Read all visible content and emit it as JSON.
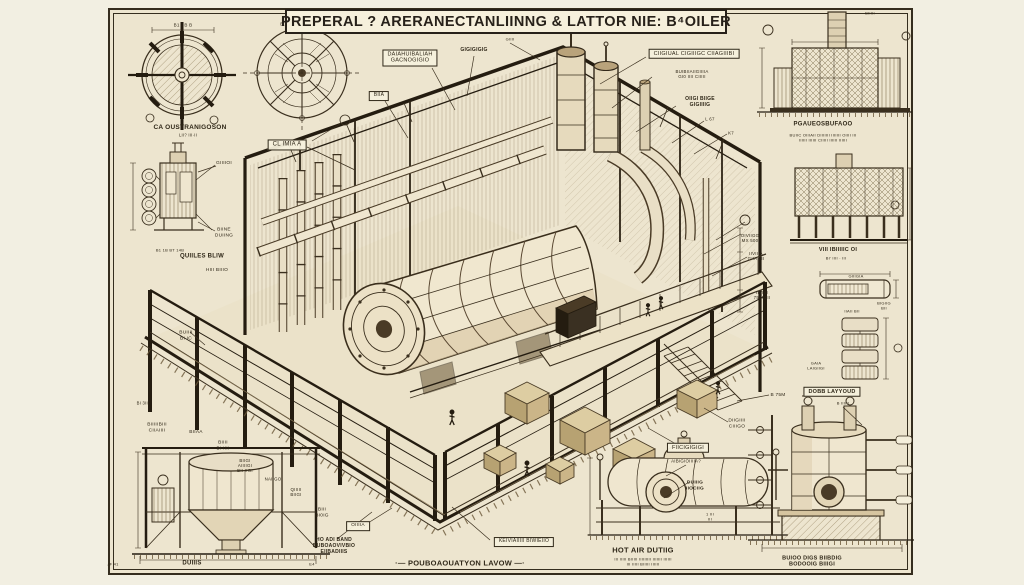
{
  "title": {
    "text": "PREPERAL ? ARERANECTANLIINNG & LATTOR NIE: B⁴OILER"
  },
  "colors": {
    "paper_margin": "#f2efe2",
    "paper_sheet": "#ede5cf",
    "ink_dark": "#241c10",
    "ink": "#3a2f1e",
    "ink_mid": "#6b5939",
    "fill_light": "#efe6cf",
    "fill_tan": "#ddd0b2",
    "fill_shade": "#d9c7a2",
    "crate_top": "#ddcda2",
    "crate_left": "#b7a272",
    "crate_right": "#cbb588"
  },
  "drawing_names": [
    "fan-section-circle-a",
    "impeller-section-circle-b",
    "left-tank-detail",
    "main-isometric-plant",
    "right-top-furnace-elevation",
    "right-mid-furnace-elevation",
    "duct-detail",
    "stacked-module-detail",
    "bottom-left-hopper",
    "hot-air-horizontal-boiler",
    "bottom-right-vertical-boiler",
    "foundation-layout"
  ],
  "labels": [
    {
      "t": "B1 · B  B",
      "x": 183,
      "y": 25,
      "s": 4.5
    },
    {
      "t": "B.BI",
      "x": 285,
      "y": 24,
      "s": 4.5
    },
    {
      "t": "CA OUSTRANIGOSON",
      "x": 190,
      "y": 128,
      "s": 6.5,
      "b": 1,
      "name": "caption-fan-section"
    },
    {
      "t": "LII? III·II",
      "x": 188,
      "y": 136,
      "s": 4.2
    },
    {
      "t": "CL IMIA  A",
      "x": 287,
      "y": 145,
      "s": 6,
      "box": 1,
      "name": "callout-cl-imia"
    },
    {
      "t": "GIIIIOI",
      "x": 224,
      "y": 164,
      "s": 4.8
    },
    {
      "t": "BIINE\nDUIING",
      "x": 224,
      "y": 233,
      "s": 4.8
    },
    {
      "t": "B1 1B      BT 14B",
      "x": 170,
      "y": 251,
      "s": 4
    },
    {
      "t": "QUIILES BLIW",
      "x": 202,
      "y": 257,
      "s": 6,
      "b": 1,
      "name": "caption-left-tank"
    },
    {
      "t": "HIII BIIIO",
      "x": 217,
      "y": 271,
      "s": 4.8
    },
    {
      "t": "BUIIII\nBI IC",
      "x": 186,
      "y": 336,
      "s": 4.8
    },
    {
      "t": "BI 3III",
      "x": 143,
      "y": 404,
      "s": 4.2
    },
    {
      "t": "BIIIIIBIII\nCIIAIIII",
      "x": 157,
      "y": 428,
      "s": 4.8
    },
    {
      "t": "BIIAA",
      "x": 196,
      "y": 433,
      "s": 4.8
    },
    {
      "t": "BIIII\nBI IIII",
      "x": 223,
      "y": 446,
      "s": 4.8
    },
    {
      "t": "BIIGI\nAIIIIGI\nBII IIGI",
      "x": 245,
      "y": 466,
      "s": 4.4
    },
    {
      "t": "NAIIGO",
      "x": 273,
      "y": 479,
      "s": 4.4
    },
    {
      "t": "QIIIII\nBIIGI",
      "x": 296,
      "y": 492,
      "s": 4.4
    },
    {
      "t": "BIII\nBI0IG",
      "x": 322,
      "y": 513,
      "s": 4.8
    },
    {
      "t": "OIIIIA",
      "x": 358,
      "y": 526,
      "s": 4.8,
      "box": 1
    },
    {
      "t": "HO ADI BAND\nBUBOAOVIVBIO\nEIIBADIIIS",
      "x": 334,
      "y": 547,
      "s": 5,
      "b": 1
    },
    {
      "t": "KEIVIAIIIII  BIWIEIIO",
      "x": 524,
      "y": 542,
      "s": 5,
      "box": 1
    },
    {
      "t": "·—   POUBOAOUATYON  LAVOW   —·",
      "x": 460,
      "y": 564,
      "s": 7.5,
      "b": 1,
      "name": "caption-foundation-layout"
    },
    {
      "t": "DUIIIS",
      "x": 192,
      "y": 564,
      "s": 6,
      "b": 1,
      "name": "caption-hopper"
    },
    {
      "t": "JF 41",
      "x": 113,
      "y": 565,
      "s": 4
    },
    {
      "t": "E4",
      "x": 312,
      "y": 565,
      "s": 4
    },
    {
      "t": "BIIA",
      "x": 379,
      "y": 96,
      "s": 5,
      "box": 1
    },
    {
      "t": "DAIAHUIBALIAH\nGACNOGIGIO",
      "x": 410,
      "y": 58,
      "s": 5.5,
      "box": 1,
      "name": "callout-top-left"
    },
    {
      "t": "GIGIGIGIG",
      "x": 474,
      "y": 51,
      "s": 5,
      "b": 1
    },
    {
      "t": "GIIII",
      "x": 510,
      "y": 40,
      "s": 4
    },
    {
      "t": "CIIGIUAL CIGIIIGC CIIAGIIIBI",
      "x": 694,
      "y": 54,
      "s": 5.5,
      "box": 1,
      "name": "callout-top-right"
    },
    {
      "t": "BUIBIIAIIGIIIIA\nGI0 IIII CIIIII",
      "x": 692,
      "y": 74,
      "s": 4.4
    },
    {
      "t": "OIIGI BIIGE\nGIGIIIIG",
      "x": 700,
      "y": 103,
      "s": 5,
      "b": 1
    },
    {
      "t": "L 67",
      "x": 710,
      "y": 119,
      "s": 4.4
    },
    {
      "t": "K7",
      "x": 731,
      "y": 133,
      "s": 4.4
    },
    {
      "t": "BIIIII",
      "x": 870,
      "y": 14,
      "s": 4
    },
    {
      "t": "PGAUEOSBUFAOO",
      "x": 823,
      "y": 125,
      "s": 6,
      "b": 1,
      "name": "caption-right-top"
    },
    {
      "t": "BUIIC OIIIAII DIIIIIII IIIIIII OIIII III\nIIIIII IIIIII CIIIII IIIIII IIIIII",
      "x": 823,
      "y": 138,
      "s": 4
    },
    {
      "t": "VIII IBIIIIIC OI",
      "x": 838,
      "y": 250,
      "s": 5.5,
      "b": 1,
      "name": "caption-right-mid"
    },
    {
      "t": "BI' IIII · III",
      "x": 836,
      "y": 259,
      "s": 4
    },
    {
      "t": "GIIIGIA",
      "x": 856,
      "y": 277,
      "s": 4
    },
    {
      "t": "BIGIIG\nBII",
      "x": 884,
      "y": 306,
      "s": 4
    },
    {
      "t": "IIAII BII",
      "x": 852,
      "y": 312,
      "s": 4
    },
    {
      "t": "GAIA\nLAIGIIGI",
      "x": 816,
      "y": 366,
      "s": 4
    },
    {
      "t": "DOBB LAYYOUD",
      "x": 832,
      "y": 392,
      "s": 5.5,
      "b": 1,
      "box": 1,
      "name": "callout-dobb-layout"
    },
    {
      "t": "OIVIIGG\nMX 500",
      "x": 750,
      "y": 238,
      "s": 4.4
    },
    {
      "t": "IIVIIIA\nGIIA 3II",
      "x": 756,
      "y": 256,
      "s": 4.4
    },
    {
      "t": "IIVIIII\n75I 50II",
      "x": 762,
      "y": 295,
      "s": 4.4
    },
    {
      "t": "B 75M",
      "x": 778,
      "y": 396,
      "s": 4.8
    },
    {
      "t": "DIIGIIII\nCIIIGO",
      "x": 737,
      "y": 424,
      "s": 4.8
    },
    {
      "t": "B IIIIII",
      "x": 843,
      "y": 404,
      "s": 4
    },
    {
      "t": "FIICIGIGIGI",
      "x": 688,
      "y": 448,
      "s": 5.5,
      "box": 1,
      "name": "callout-fiicig"
    },
    {
      "t": "AIBIGIOIIIIA?",
      "x": 686,
      "y": 461,
      "s": 4.4
    },
    {
      "t": "DUIIIG\nIIOCIIG",
      "x": 695,
      "y": 486,
      "s": 4.8,
      "b": 1
    },
    {
      "t": "1 III\nIII",
      "x": 710,
      "y": 517,
      "s": 4
    },
    {
      "t": "HOT AIR DUTIIG",
      "x": 643,
      "y": 551,
      "s": 7.5,
      "b": 1,
      "name": "caption-hot-air"
    },
    {
      "t": "III IIIII BIIIII IIIIIIIII IIIIIII IIIIII\nIII IIIII BIIIII IIIIII",
      "x": 643,
      "y": 562,
      "s": 4
    },
    {
      "t": "BUIOO DIGS BIIBDIG\nBODOOIG BIIIGI",
      "x": 812,
      "y": 562,
      "s": 5.5,
      "b": 1,
      "name": "caption-bottom-right"
    }
  ]
}
